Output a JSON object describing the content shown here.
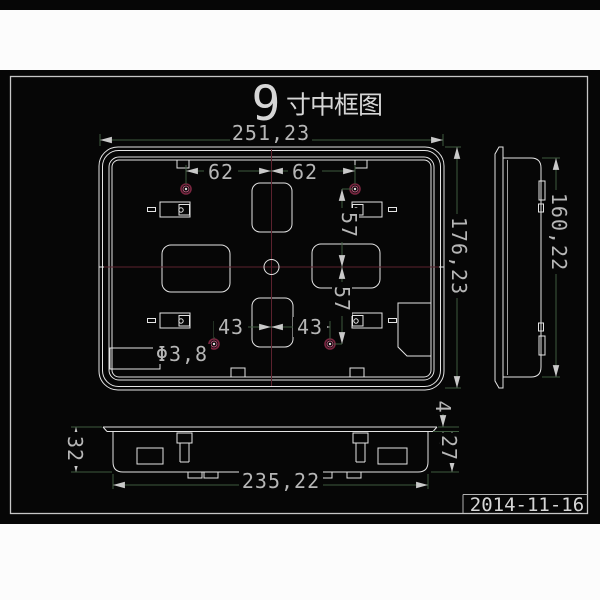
{
  "title": {
    "size_number": "9",
    "name": "寸中框图"
  },
  "front_view": {
    "dim_width": "251,23",
    "dim_height": "176,23",
    "dim_top_hole_left": "62",
    "dim_top_hole_right": "62",
    "dim_hole_row_upper": "57",
    "dim_hole_row_lower": "57",
    "dim_bottom_hole_left": "43",
    "dim_bottom_hole_right": "43",
    "hole_diameter": "Φ3,8"
  },
  "side_view": {
    "dim_height": "160,22"
  },
  "bottom_view": {
    "dim_width": "235,22",
    "dim_total_depth": "32",
    "dim_flange_thickness": "4",
    "dim_body_depth": "27"
  },
  "title_block": {
    "date": "2014-11-16"
  },
  "colors": {
    "canvas": "#060606",
    "page": "#fcfcfc",
    "outline": "#e4e4e4",
    "dimension_line": "#3f5b3f",
    "center_line": "#5c222e",
    "hole_mark": "#7a2640",
    "dim_text": "#b6b6b6",
    "border": "#c6c6c6"
  }
}
